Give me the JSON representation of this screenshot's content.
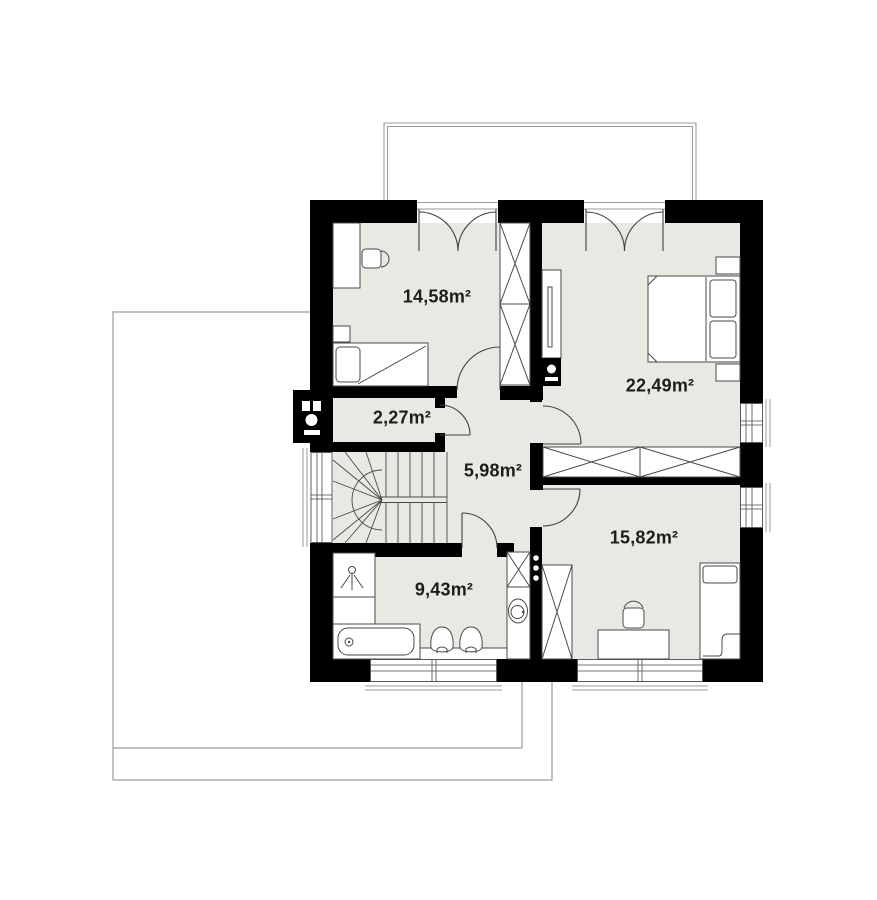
{
  "plan": {
    "rooms": [
      {
        "name": "bedroom-top-left",
        "area": "14,58m²"
      },
      {
        "name": "bedroom-top-right",
        "area": "22,49m²"
      },
      {
        "name": "closet-wc",
        "area": "2,27m²"
      },
      {
        "name": "hall-landing",
        "area": "5,98m²"
      },
      {
        "name": "bedroom-bottom-right",
        "area": "15,82m²"
      },
      {
        "name": "bathroom",
        "area": "9,43m²"
      }
    ],
    "colors": {
      "wall": "#000000",
      "floor": "#e9e8e3",
      "furniture_outline": "#4a4a4a",
      "thin_outline": "#9b9b9b",
      "label_text": "#1d1d1b"
    }
  }
}
